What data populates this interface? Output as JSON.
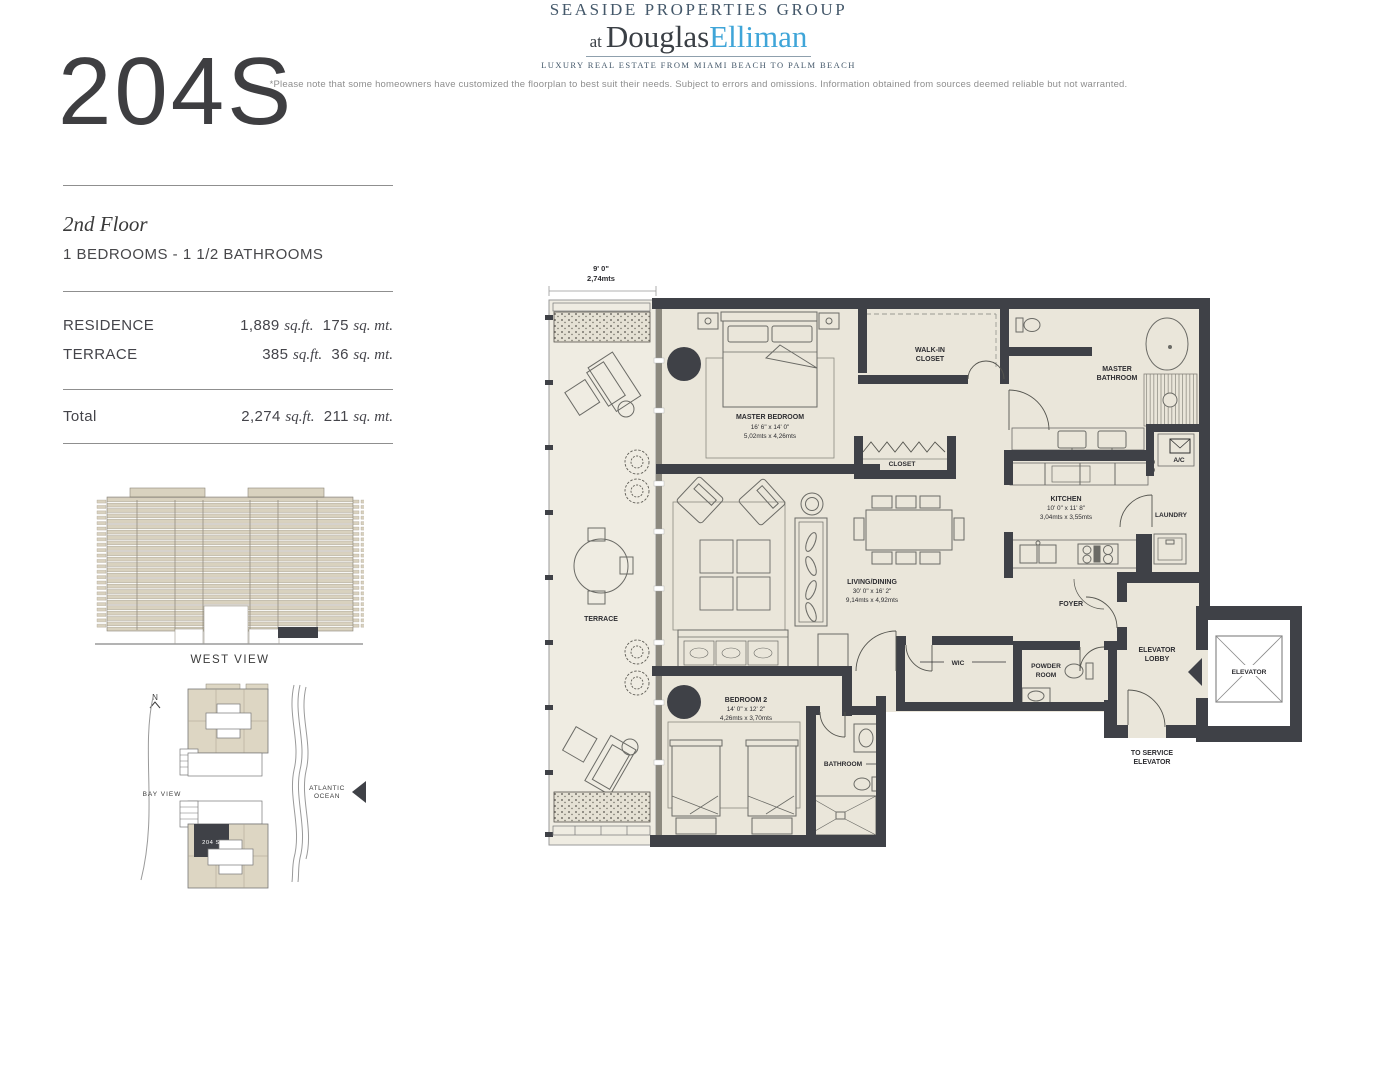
{
  "header": {
    "unit_number": "204S",
    "floor": "2nd Floor",
    "configuration": "1 BEDROOMS - 1 1/2 BATHROOMS"
  },
  "areas": {
    "residence": {
      "label": "RESIDENCE",
      "sqft": "1,889",
      "sqmt": "175"
    },
    "terrace": {
      "label": "TERRACE",
      "sqft": "385",
      "sqmt": "36"
    },
    "total": {
      "label": "Total",
      "sqft": "2,274",
      "sqmt": "211"
    },
    "sqft_unit": "sq.ft.",
    "sqmt_unit": "sq. mt."
  },
  "west_view": {
    "label": "WEST VIEW"
  },
  "site_map": {
    "north": "N",
    "bay_label": "BAY VIEW",
    "ocean_label_1": "ATLANTIC",
    "ocean_label_2": "OCEAN",
    "unit_marker": "204 S"
  },
  "plan": {
    "terrace_dim_ft": "9' 0\"",
    "terrace_dim_m": "2,74mts",
    "terrace": "TERRACE",
    "master_bedroom": "MASTER BEDROOM",
    "master_bedroom_ft": "16' 6\" x 14' 0\"",
    "master_bedroom_m": "5,02mts x 4,26mts",
    "walk_in_closet_1": "WALK-IN",
    "walk_in_closet_2": "CLOSET",
    "master_bathroom_1": "MASTER",
    "master_bathroom_2": "BATHROOM",
    "closet": "CLOSET",
    "kitchen": "KITCHEN",
    "kitchen_ft": "10' 0\" x 11' 8\"",
    "kitchen_m": "3,04mts x 3,55mts",
    "ac": "A/C",
    "laundry": "LAUNDRY",
    "living_dining": "LIVING/DINING",
    "living_dining_ft": "30' 0\" x 16' 2\"",
    "living_dining_m": "9,14mts x 4,92mts",
    "foyer": "FOYER",
    "elevator_lobby_1": "ELEVATOR",
    "elevator_lobby_2": "LOBBY",
    "elevator": "ELEVATOR",
    "powder_room_1": "POWDER",
    "powder_room_2": "ROOM",
    "wic": "WIC",
    "bedroom_2": "BEDROOM 2",
    "bedroom_2_ft": "14' 0\" x 12' 2\"",
    "bedroom_2_m": "4,26mts x 3,70mts",
    "bathroom": "BATHROOM",
    "to_service_1": "TO SERVICE",
    "to_service_2": "ELEVATOR"
  },
  "footer": {
    "brand_top": "SEASIDE PROPERTIES GROUP",
    "brand_at": "at",
    "brand_name_1": "Douglas",
    "brand_name_2": "Elliman",
    "tagline": "LUXURY REAL ESTATE FROM MIAMI BEACH TO PALM BEACH",
    "disclaimer": "*Please note that some homeowners have customized the floorplan to best suit their needs. Subject to errors and omissions. Information obtained from sources deemed reliable but not warranted."
  },
  "colors": {
    "wall": "#3F4147",
    "interior": "#EAE6DA",
    "terrace_floor": "#EFECE2",
    "elevation_beige": "#D9D2BF",
    "elliman_blue": "#3FA5D8",
    "brand_slate": "#44586A"
  }
}
